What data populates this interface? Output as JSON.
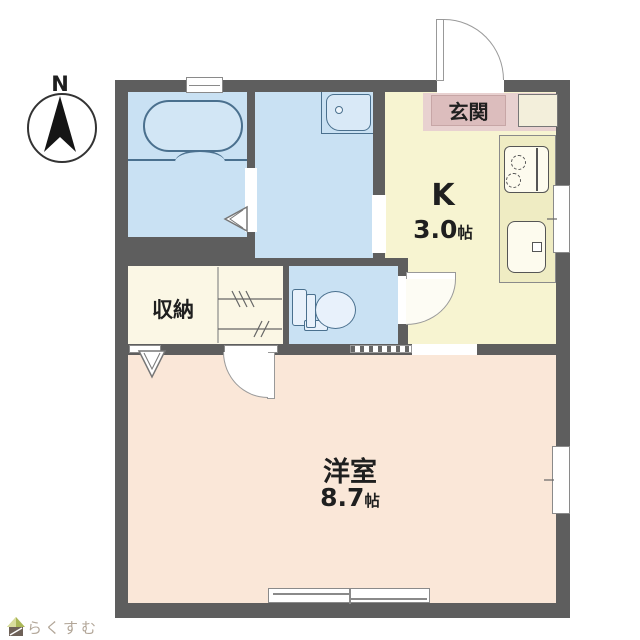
{
  "title": "apartment-floor-plan",
  "compass": {
    "label": "N"
  },
  "rooms": {
    "entrance": {
      "label": "玄関"
    },
    "kitchen": {
      "label": "K",
      "size_value": "3.0",
      "size_unit": "帖"
    },
    "closet": {
      "label": "収納"
    },
    "western_room": {
      "label": "洋室",
      "size_value": "8.7",
      "size_unit": "帖"
    }
  },
  "fixtures": [
    "bathtub",
    "washbasin",
    "toilet",
    "gas-stove",
    "kitchen-sink",
    "shoe-cabinet"
  ],
  "logo": {
    "text": "らくすむ"
  },
  "colors": {
    "wall": "#5e5e5e",
    "wet_area_floor": "#c9e1f3",
    "kitchen_floor": "#f7f4d1",
    "entrance_floor": "#e8d1d0",
    "entrance_label_bg": "#dcbdbd",
    "closet_floor": "#fbf7e5",
    "room_floor": "#fae7d8",
    "fixture_outline": "#4a708e",
    "text": "#1f1f1f",
    "logo_text": "#b2a698"
  }
}
